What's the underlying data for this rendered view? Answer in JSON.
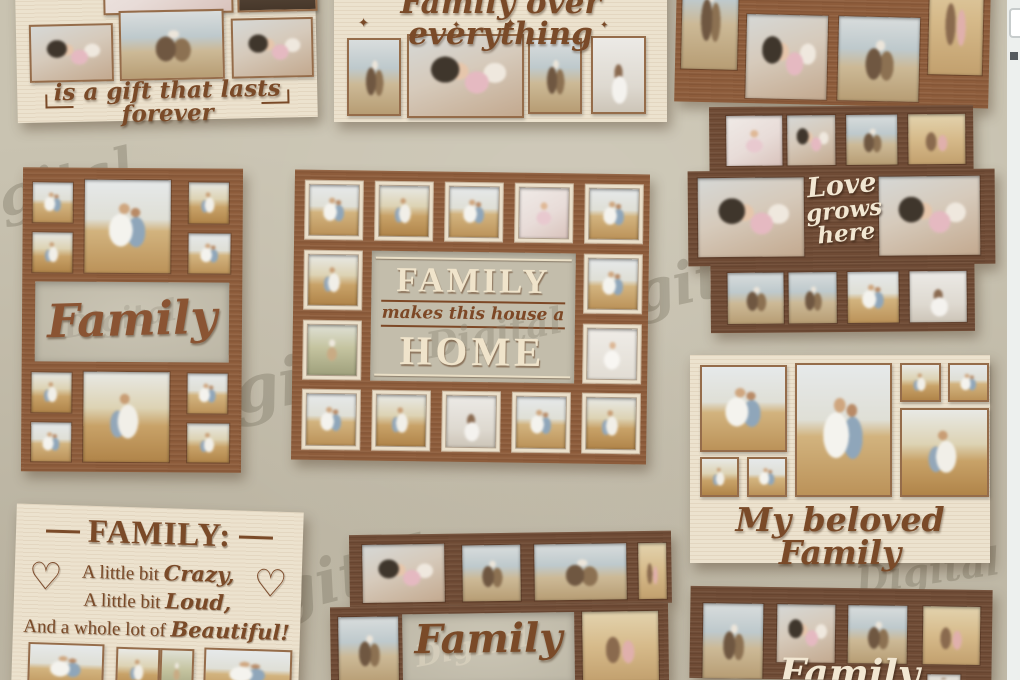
{
  "watermark": {
    "text": "Digital"
  },
  "colors": {
    "wall": "#c9c3b1",
    "frame_cream": "#ece2ce",
    "frame_brown": "#8d5c3b",
    "frame_dark_brown": "#6f4b35",
    "text_brown": "#7a4a28",
    "text_cream": "#f2e7d2",
    "page_edge": "#edf0ee"
  },
  "frames": {
    "gift": {
      "caption": "is a gift that lasts forever"
    },
    "over_everything": {
      "caption": "Family over everything",
      "sparkle": "✦"
    },
    "love_grows": {
      "lines": [
        "Love",
        "grows",
        "here"
      ]
    },
    "family_left": {
      "caption": "Family"
    },
    "home": {
      "line1": "FAMILY",
      "line2": "makes this house a",
      "line3": "HOME"
    },
    "beloved": {
      "caption": "My beloved Family"
    },
    "definition": {
      "title": "FAMILY:",
      "heart": "♡",
      "lines": [
        {
          "prefix": "A little bit ",
          "script": "Crazy,"
        },
        {
          "prefix": "A little bit ",
          "script": "Loud,"
        },
        {
          "prefix": "And a whole lot of ",
          "script": "Beautiful!"
        }
      ]
    },
    "family_bottom": {
      "caption": "Family"
    },
    "family_right": {
      "caption": "Family"
    }
  }
}
